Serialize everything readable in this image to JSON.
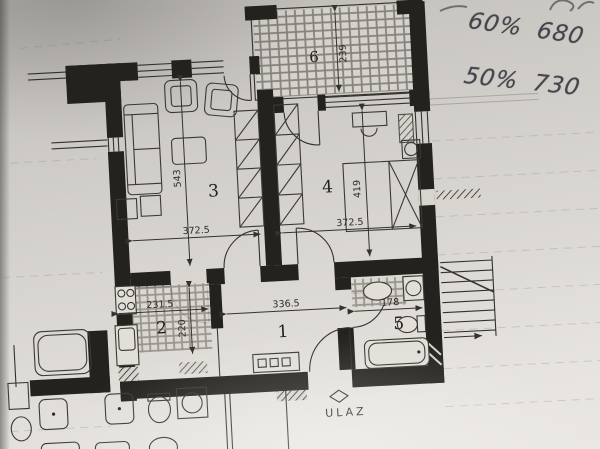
{
  "notes": {
    "line1": "60% 680",
    "line2": "50% 730"
  },
  "plan": {
    "entrance_label": "ULAZ",
    "rooms": {
      "hall": {
        "number": "1",
        "width": "336.5"
      },
      "kitchen": {
        "number": "2",
        "width": "231.5",
        "depth": "220"
      },
      "living": {
        "number": "3",
        "width": "372.5",
        "depth": "543"
      },
      "bedroom": {
        "number": "4",
        "width": "372.5",
        "depth": "419"
      },
      "bathroom": {
        "number": "5",
        "width": "178"
      },
      "terrace": {
        "number": "6",
        "depth": "239"
      }
    }
  },
  "colors": {
    "paper": "#d8d5d0",
    "ink": "#2b2925",
    "handwriting": "#45444c"
  }
}
